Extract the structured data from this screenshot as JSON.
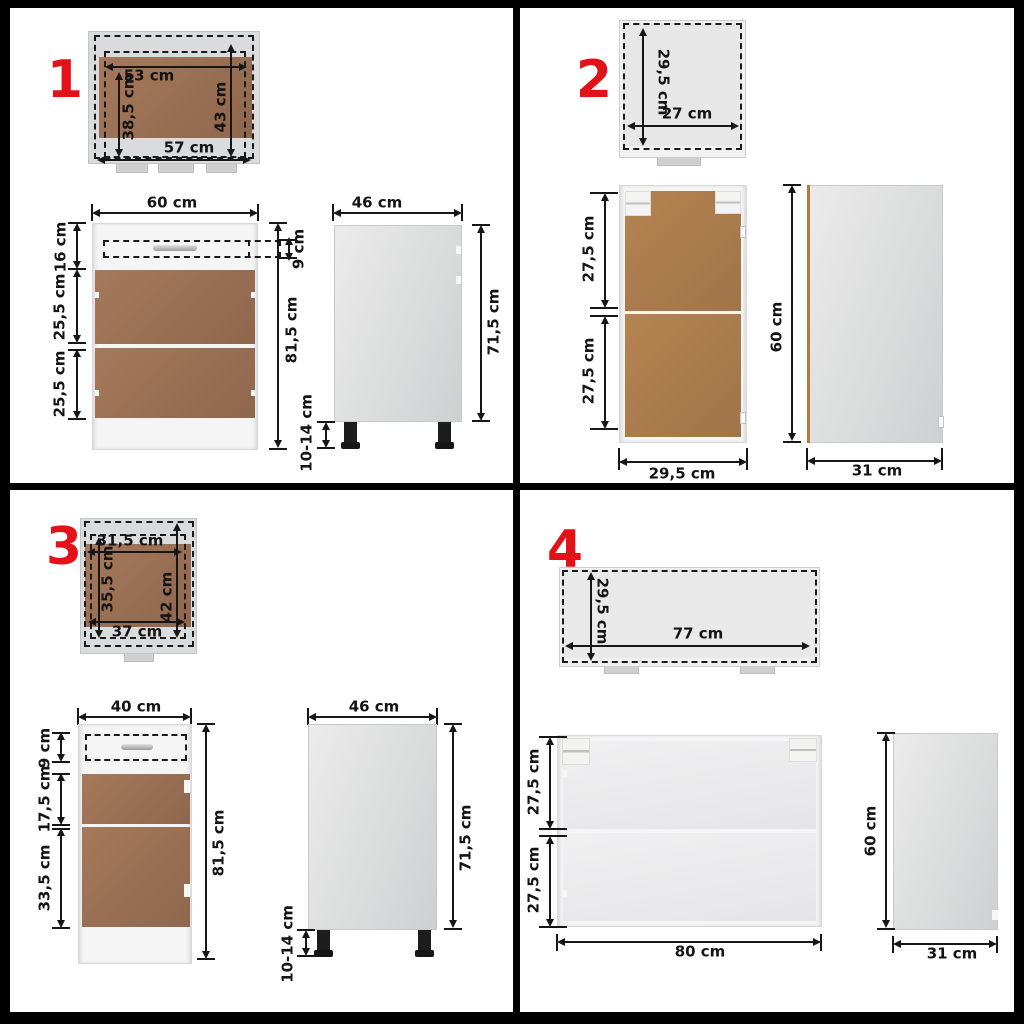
{
  "badges": {
    "q1": "1",
    "q2": "2",
    "q3": "3",
    "q4": "4"
  },
  "q1": {
    "top": {
      "w_in": "53 cm",
      "w_out": "57 cm",
      "h_in": "38,5 cm",
      "h_out": "43 cm"
    },
    "front": {
      "w": "60 cm",
      "top": "16 cm",
      "mid": "25,5 cm",
      "bot": "25,5 cm",
      "h": "81,5 cm",
      "drawer": "9 cm"
    },
    "side": {
      "w": "46 cm",
      "h": "71,5 cm",
      "legs": "10-14 cm"
    }
  },
  "q2": {
    "top": {
      "d": "29,5 cm",
      "w": "27 cm"
    },
    "front": {
      "top": "27,5 cm",
      "bot": "27,5 cm",
      "w": "29,5 cm"
    },
    "side": {
      "h": "60 cm",
      "d": "31 cm"
    }
  },
  "q3": {
    "top": {
      "w_in": "31,5 cm",
      "h_in": "35,5 cm",
      "h_out": "42 cm",
      "w_out": "37 cm"
    },
    "front": {
      "w": "40 cm",
      "top": "9 cm",
      "mid": "17,5 cm",
      "bot": "33,5 cm",
      "h": "81,5 cm"
    },
    "side": {
      "w": "46 cm",
      "h": "71,5 cm",
      "legs": "10-14 cm"
    }
  },
  "q4": {
    "top": {
      "d": "29,5 cm",
      "w": "77 cm"
    },
    "front": {
      "top": "27,5 cm",
      "bot": "27,5 cm",
      "w": "80 cm"
    },
    "side": {
      "h": "60 cm",
      "d": "31 cm"
    }
  },
  "colors": {
    "accent_red": "#e31219",
    "door_brown": "#9b7154",
    "interior_brown": "#b0804e",
    "panel_gray": "#dadbdc",
    "line_black": "#161616"
  }
}
